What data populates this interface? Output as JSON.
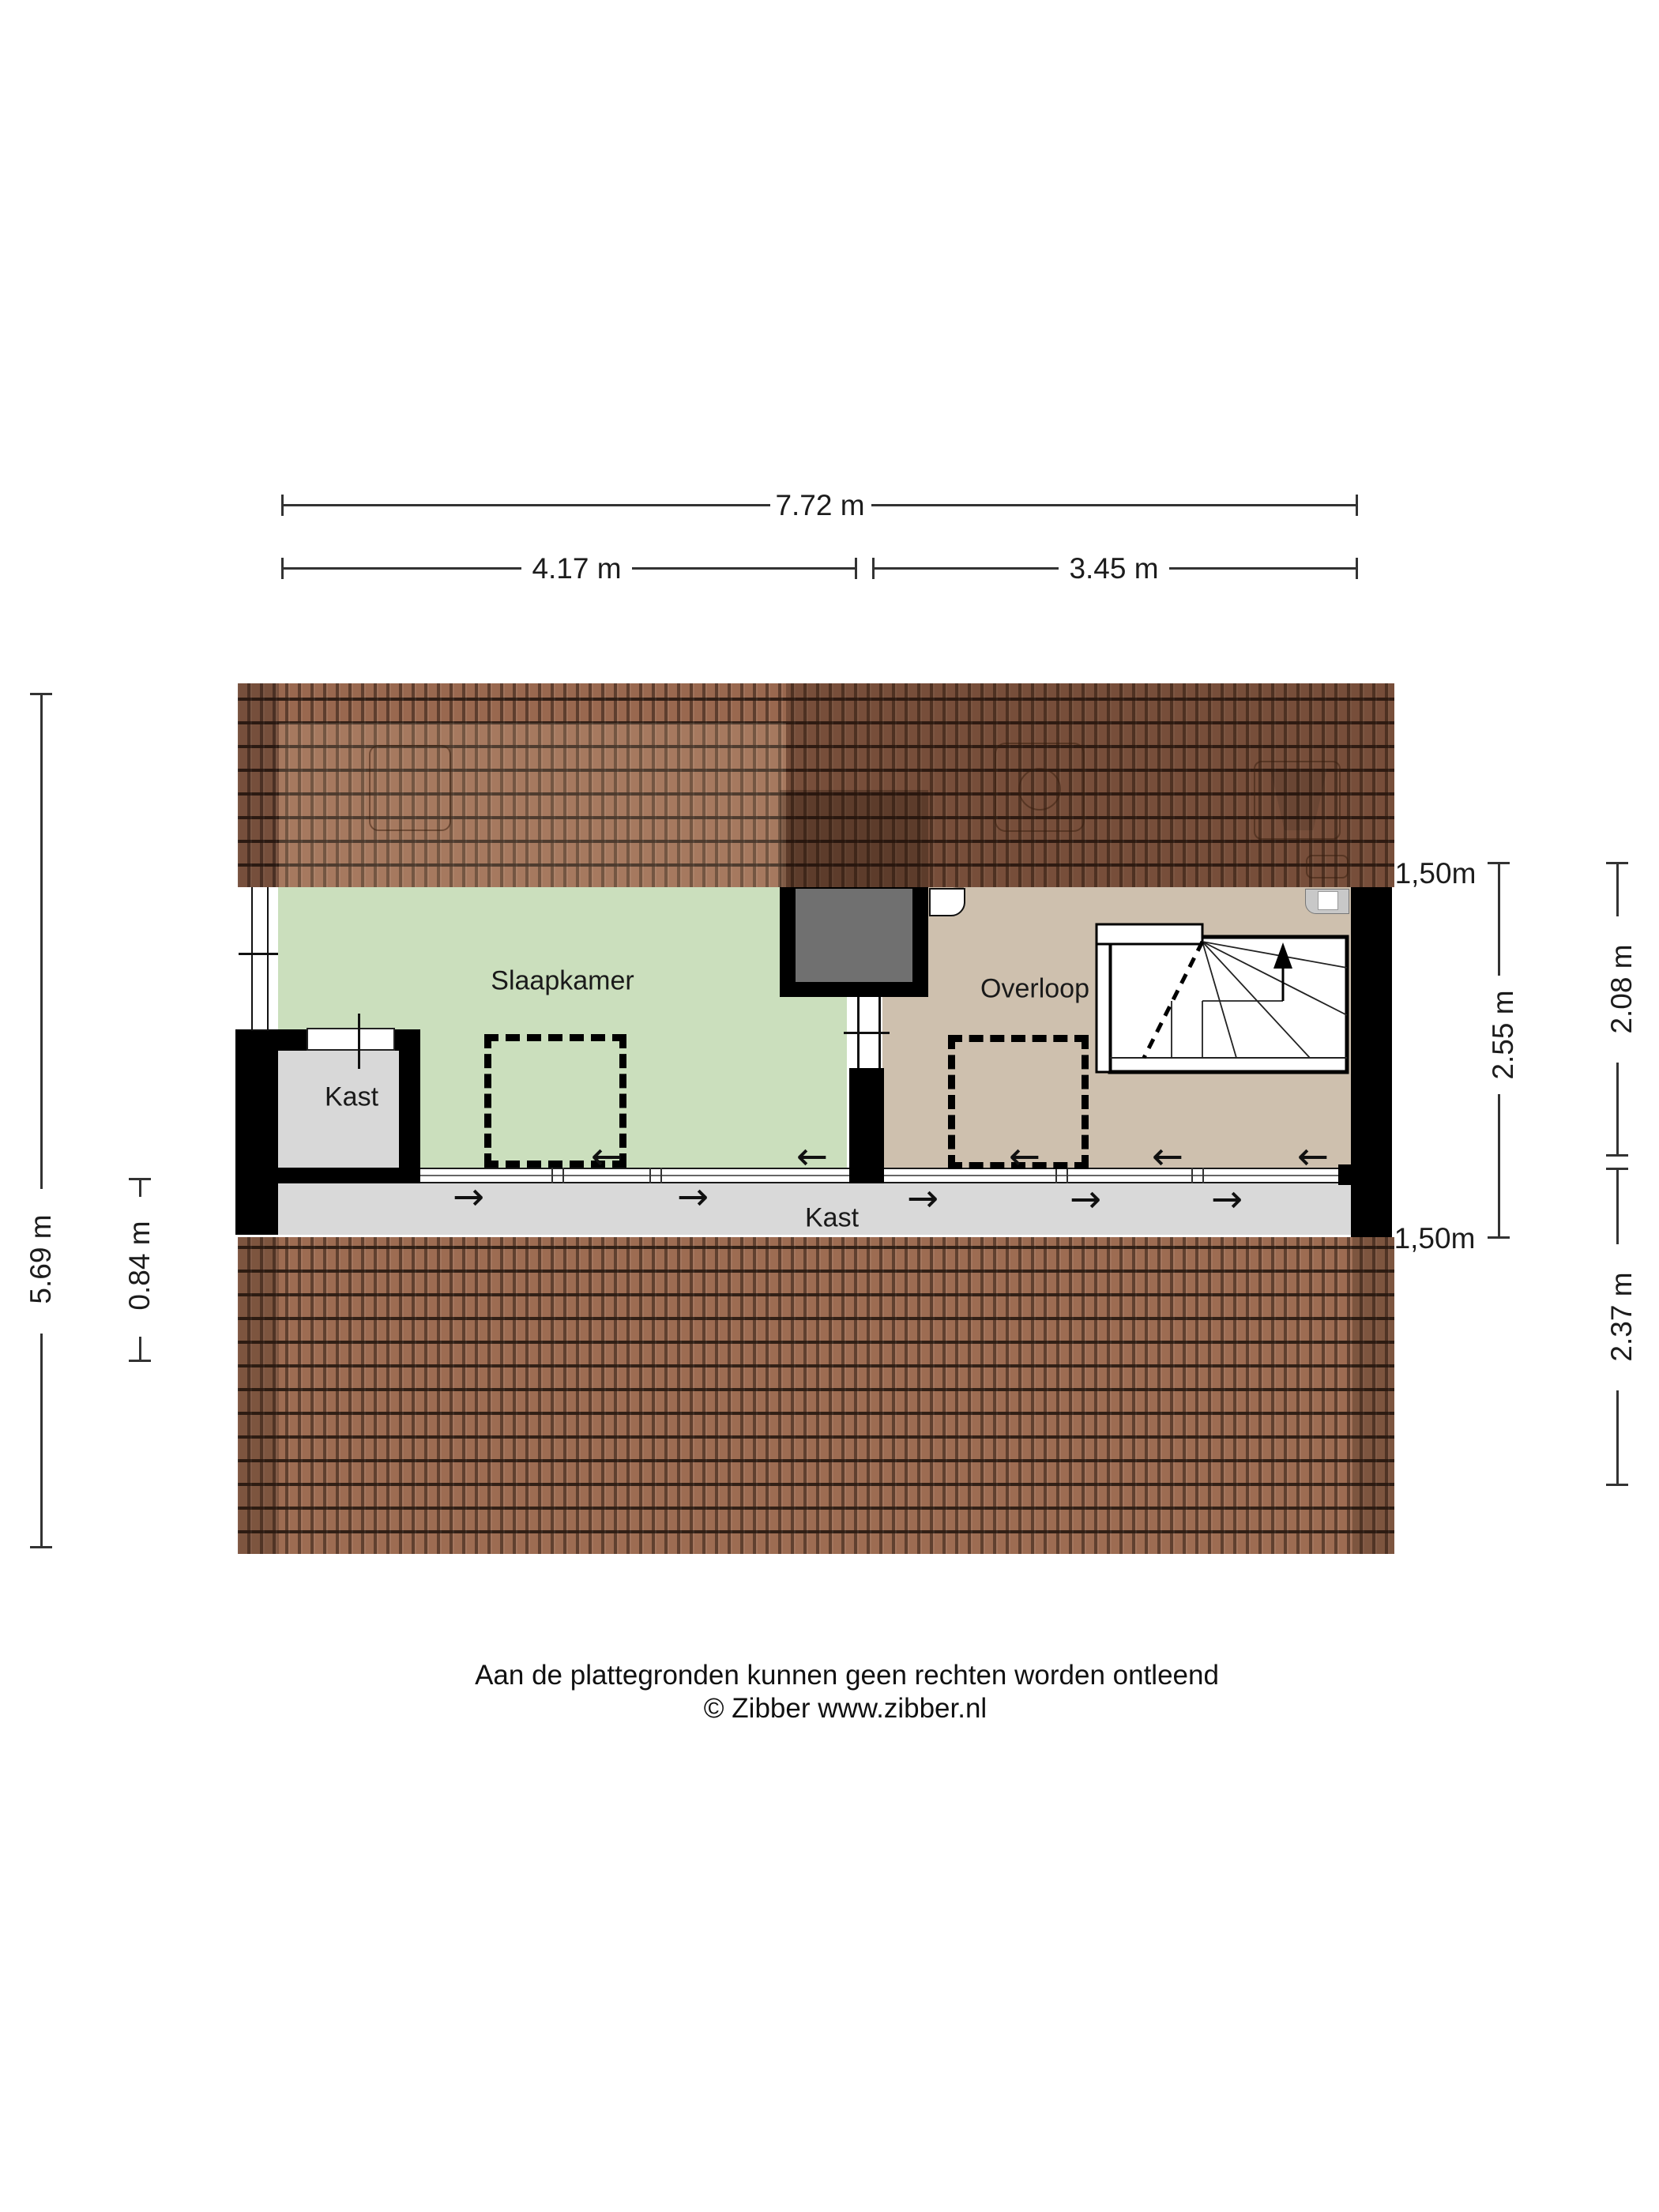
{
  "rooms": {
    "slaapkamer": "Slaapkamer",
    "overloop": "Overloop",
    "kast_closet": "Kast",
    "kast_strip": "Kast"
  },
  "dimensions": {
    "total_width": "7.72 m",
    "width_left": "4.17 m",
    "width_right": "3.45 m",
    "total_height": "5.69 m",
    "height_offset": "0.84 m",
    "headroom": "1,50m",
    "room_depth": "2.55 m",
    "upper_depth": "2.08 m",
    "lower_depth": "2.37 m"
  },
  "icons": {
    "arrow_left": "←",
    "arrow_right": "→"
  },
  "footer": {
    "disclaimer": "Aan de plattegronden kunnen geen rechten worden ontleend",
    "credit": "© Zibber www.zibber.nl"
  },
  "colors": {
    "wall": "#000000",
    "green": "#cbdfbd",
    "tan": "#cec0ae",
    "strip": "#d9d9d9",
    "closet": "#d8d8d8",
    "chimney": "#707070",
    "roof_top": "#99684f",
    "roof_bottom": "#9d6c52",
    "dim": "#333333",
    "text": "#1a1a1a"
  }
}
